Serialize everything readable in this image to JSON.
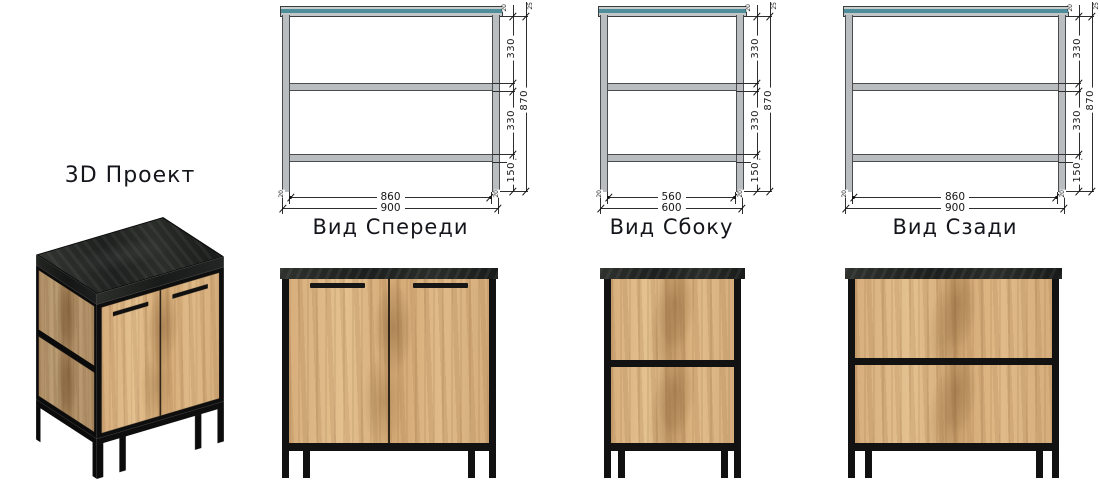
{
  "project": {
    "title_3d": "3D Проект"
  },
  "views": {
    "front": {
      "title": "Вид Спереди",
      "inner_width": "860",
      "outer_width": "900",
      "left_edge": "20",
      "right_edge": "20"
    },
    "side": {
      "title": "Вид Сбоку",
      "inner_width": "560",
      "outer_width": "600",
      "left_edge": "20",
      "right_edge": "20"
    },
    "back": {
      "title": "Вид Сзади",
      "inner_width": "860",
      "outer_width": "900",
      "left_edge": "20",
      "right_edge": "20"
    }
  },
  "vertical_dims": {
    "frame_tube": "20",
    "top_thickness": "25",
    "upper_section": "330",
    "lower_section": "330",
    "floor_clearance": "150",
    "overall_height": "870"
  },
  "colors": {
    "background": "#ffffff",
    "drawing_top_panel_teal": "#4e8e9a",
    "drawing_frame_gray": "#b9bdc0",
    "dimension_lines": "#2e2e2e",
    "render_frame_black": "#121212",
    "render_wood_oak": "#d9b183",
    "render_top_slab": "#25272a"
  }
}
